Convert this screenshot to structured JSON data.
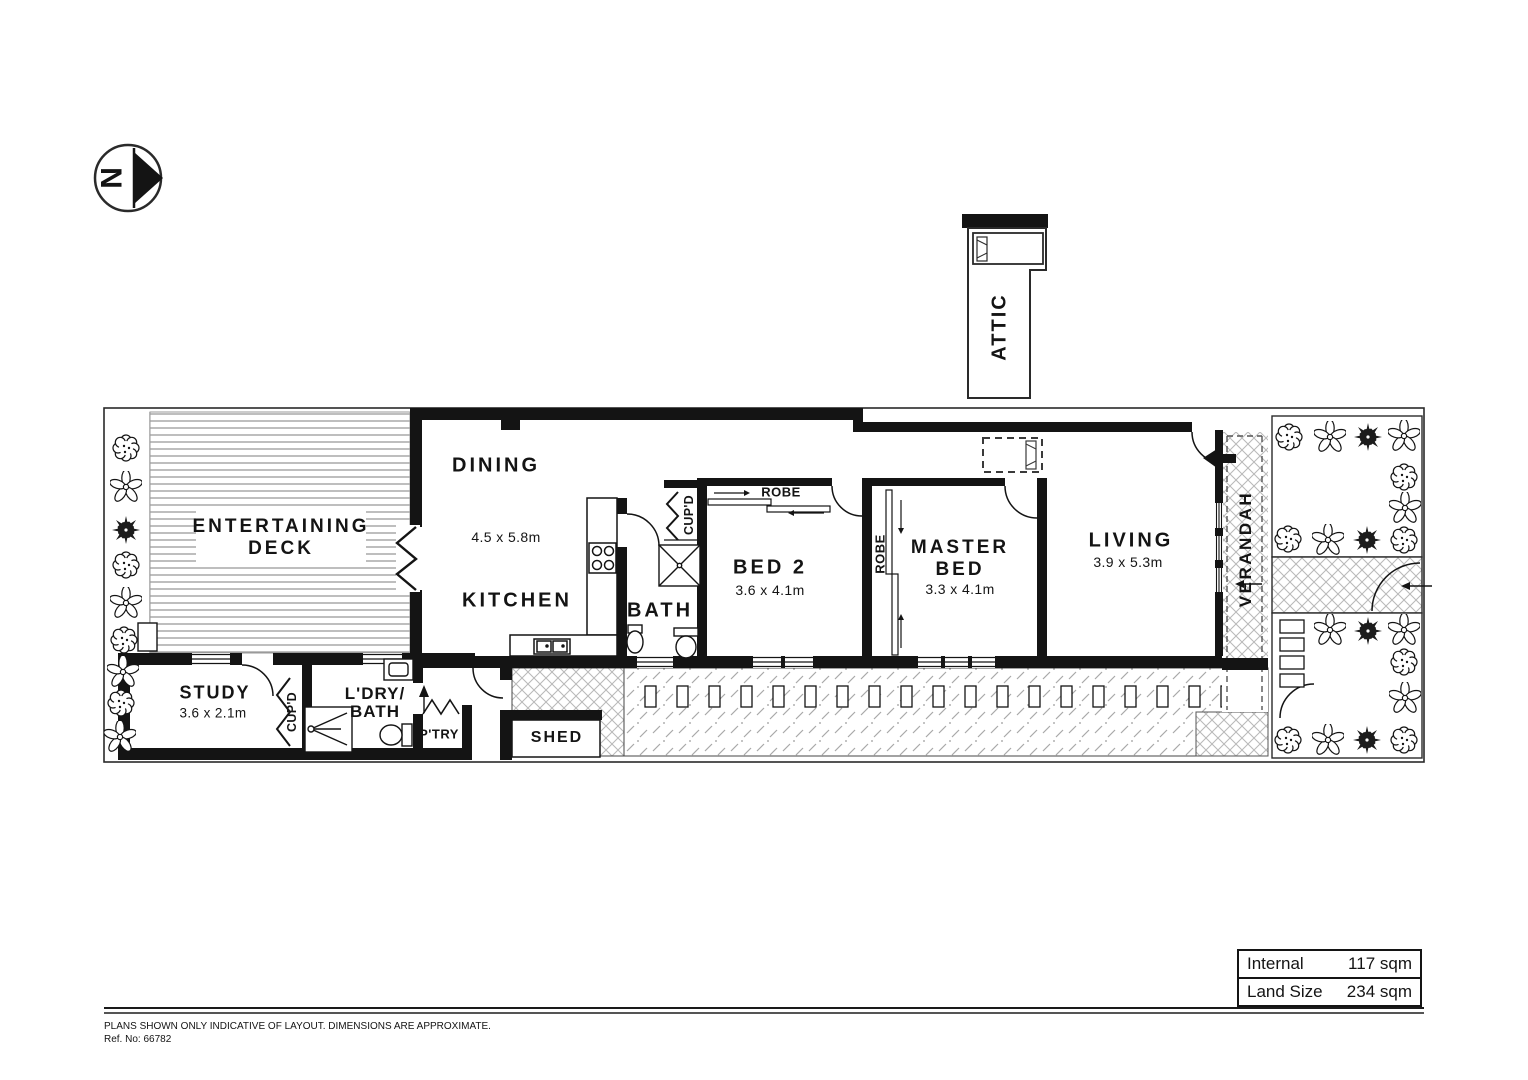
{
  "north": {
    "label": "N"
  },
  "attic": {
    "label": "ATTIC"
  },
  "plan": {
    "deck": {
      "line1": "ENTERTAINING",
      "line2": "DECK"
    },
    "dining": {
      "label": "DINING",
      "dim": "4.5 x 5.8m"
    },
    "kitchen": {
      "label": "KITCHEN"
    },
    "bath": {
      "label": "BATH"
    },
    "bed2": {
      "label": "BED 2",
      "dim": "3.6 x 4.1m",
      "robe": "ROBE"
    },
    "master": {
      "line1": "MASTER",
      "line2": "BED",
      "dim": "3.3 x 4.1m",
      "robe": "ROBE"
    },
    "living": {
      "label": "LIVING",
      "dim": "3.9 x 5.3m"
    },
    "verandah": {
      "label": "VERANDAH"
    },
    "study": {
      "label": "STUDY",
      "dim": "3.6 x 2.1m"
    },
    "ldry": {
      "line1": "L'DRY/",
      "line2": "BATH"
    },
    "ptry": {
      "label": "P'TRY"
    },
    "shed": {
      "label": "SHED"
    },
    "cupd_hall": {
      "label": "CUP'D"
    },
    "cupd_study": {
      "label": "CUP'D"
    }
  },
  "summary": {
    "rows": [
      {
        "label": "Internal",
        "value": "117 sqm"
      },
      {
        "label": "Land Size",
        "value": "234 sqm"
      }
    ]
  },
  "footer": {
    "disclaimer": "PLANS SHOWN ONLY INDICATIVE OF LAYOUT.  DIMENSIONS ARE APPROXIMATE.",
    "ref": "Ref. No: 66782"
  },
  "colors": {
    "wall": "#141414",
    "hatch": "#b8b8b8",
    "deck_stripe": "#9a9a9a",
    "paper": "#ffffff"
  }
}
